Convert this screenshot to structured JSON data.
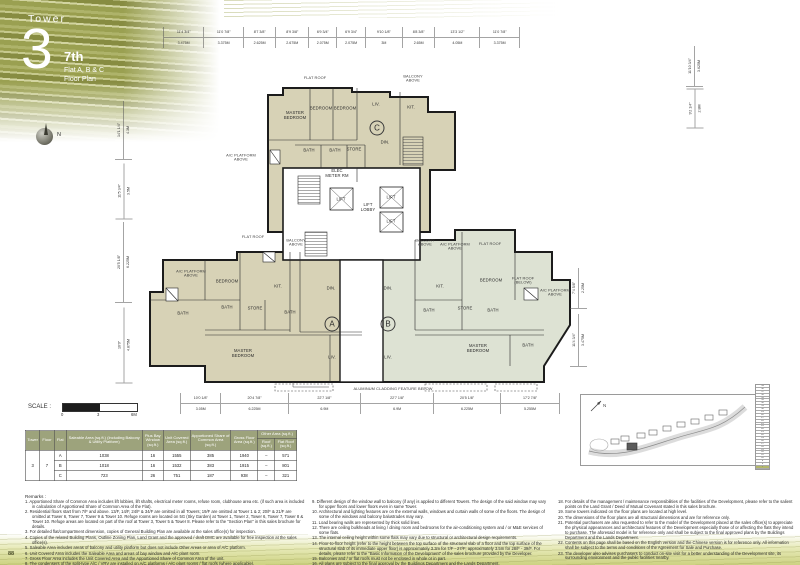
{
  "header": {
    "eyebrow": "Tower",
    "number": "3",
    "floor": "7th",
    "unit_line": "Flat A, B & C",
    "plan_line": "Floor Plan"
  },
  "compass": {
    "label": "N"
  },
  "key_plan": {
    "north_label": "N"
  },
  "page_number": "88",
  "scale_bar": {
    "label": "SCALE :",
    "ticks": [
      "0",
      "3",
      "6M"
    ]
  },
  "dims": {
    "top_pre": {
      "imp": "11'4 3/4\"",
      "met": "3.475M",
      "m": 3.475
    },
    "top": [
      {
        "imp": "11'0 7/8\"",
        "met": "3.375M",
        "m": 3.375
      },
      {
        "imp": "8'7 3/8\"",
        "met": "2.625M",
        "m": 2.625
      },
      {
        "imp": "8'9 3/8\"",
        "met": "2.675M",
        "m": 2.675
      },
      {
        "imp": "6'9 3/4\"",
        "met": "2.075M",
        "m": 2.075
      },
      {
        "imp": "6'9 3/4\"",
        "met": "2.075M",
        "m": 2.075
      },
      {
        "imp": "9'10 1/8\"",
        "met": "3M",
        "m": 3
      },
      {
        "imp": "8'8 3/8\"",
        "met": "2.65M",
        "m": 2.65
      },
      {
        "imp": "13'3 1/2\"",
        "met": "4.05M",
        "m": 4.05
      },
      {
        "imp": "11'0 7/8\"",
        "met": "3.375M",
        "m": 3.375
      }
    ],
    "bottom": [
      {
        "imp": "10'0 1/8\"",
        "met": "3.05M",
        "m": 3.05
      },
      {
        "imp": "20'4 7/8\"",
        "met": "6.225M",
        "m": 6.225
      },
      {
        "imp": "22'7 1/8\"",
        "met": "6.9M",
        "m": 6.9
      },
      {
        "imp": "22'7 1/8\"",
        "met": "6.9M",
        "m": 6.9
      },
      {
        "imp": "20'5 1/8\"",
        "met": "6.225M",
        "m": 6.225
      },
      {
        "imp": "17'2 7/8\"",
        "met": "5.255M",
        "m": 5.255
      }
    ],
    "left": [
      {
        "imp": "14'1 1/4\"",
        "met": "4.3M",
        "cx": 123,
        "cy": 130,
        "len": 58
      },
      {
        "imp": "11'5 3/4\"",
        "met": "3.5M",
        "cx": 123,
        "cy": 191,
        "len": 55
      },
      {
        "imp": "20'5 1/8\"",
        "met": "6.225M",
        "cx": 123,
        "cy": 262,
        "len": 80
      },
      {
        "imp": "16'0\"",
        "met": "4.875M",
        "cx": 123,
        "cy": 345,
        "len": 75
      }
    ],
    "right": [
      {
        "imp": "7'4 5/8\"",
        "met": "2.25M",
        "cx": 578,
        "cy": 288,
        "len": 40
      },
      {
        "imp": "11'4 3/4\"",
        "met": "3.475M",
        "cx": 578,
        "cy": 340,
        "len": 52
      }
    ],
    "top_right": [
      {
        "imp": "11'10 3/4\"",
        "met": "3.625M",
        "cx": 694,
        "cy": 66,
        "len": 40
      },
      {
        "imp": "9'2 1/4\"",
        "met": "2.8M",
        "cx": 694,
        "cy": 108,
        "len": 38
      }
    ]
  },
  "plan": {
    "cladding": "ALUMINUM CLADDING FEATURE BELOW",
    "circles": [
      {
        "t": "C",
        "x": 252,
        "y": 80
      },
      {
        "t": "A",
        "x": 207,
        "y": 276
      },
      {
        "t": "B",
        "x": 263,
        "y": 276
      }
    ],
    "labels": [
      {
        "t": "FLAT ROOF",
        "x": 190,
        "y": 30,
        "s": "note"
      },
      {
        "t": "BALCONY\nABOVE",
        "x": 288,
        "y": 31,
        "s": "note"
      },
      {
        "t": "A/C PLATFORM\nABOVE",
        "x": 116,
        "y": 110,
        "s": "note"
      },
      {
        "t": "MASTER\nBEDROOM",
        "x": 170,
        "y": 68
      },
      {
        "t": "BEDROOM",
        "x": 196,
        "y": 61
      },
      {
        "t": "BEDROOM",
        "x": 220,
        "y": 61
      },
      {
        "t": "LIV.",
        "x": 251,
        "y": 57
      },
      {
        "t": "KIT.",
        "x": 286,
        "y": 60
      },
      {
        "t": "DIN.",
        "x": 260,
        "y": 95
      },
      {
        "t": "BATH",
        "x": 184,
        "y": 103
      },
      {
        "t": "BATH",
        "x": 210,
        "y": 103
      },
      {
        "t": "STORE",
        "x": 229,
        "y": 102
      },
      {
        "t": "ELEC\nMETER RM",
        "x": 212,
        "y": 126
      },
      {
        "t": "LIFT",
        "x": 216,
        "y": 152
      },
      {
        "t": "LIFT\nLOBBY",
        "x": 243,
        "y": 160
      },
      {
        "t": "LIFT",
        "x": 266,
        "y": 150
      },
      {
        "t": "LIFT",
        "x": 266,
        "y": 174
      },
      {
        "t": "FLAT ROOF",
        "x": 128,
        "y": 189,
        "s": "note"
      },
      {
        "t": "BALCONY\nABOVE",
        "x": 171,
        "y": 195,
        "s": "note"
      },
      {
        "t": "A/C PLATFORM\nABOVE",
        "x": 66,
        "y": 226,
        "s": "note"
      },
      {
        "t": "BEDROOM",
        "x": 102,
        "y": 234
      },
      {
        "t": "KIT.",
        "x": 153,
        "y": 239
      },
      {
        "t": "DIN.",
        "x": 206,
        "y": 241
      },
      {
        "t": "BATH",
        "x": 58,
        "y": 266
      },
      {
        "t": "BATH",
        "x": 102,
        "y": 260
      },
      {
        "t": "STORE",
        "x": 130,
        "y": 261
      },
      {
        "t": "BATH",
        "x": 165,
        "y": 265
      },
      {
        "t": "MASTER\nBEDROOM",
        "x": 118,
        "y": 306
      },
      {
        "t": "LIV.",
        "x": 207,
        "y": 310
      },
      {
        "t": "BALCONY\nABOVE",
        "x": 300,
        "y": 195,
        "s": "note"
      },
      {
        "t": "A/C PLATFORM\nABOVE",
        "x": 330,
        "y": 199,
        "s": "note"
      },
      {
        "t": "FLAT ROOF",
        "x": 365,
        "y": 196,
        "s": "note"
      },
      {
        "t": "DIN.",
        "x": 263,
        "y": 241
      },
      {
        "t": "KIT.",
        "x": 315,
        "y": 239
      },
      {
        "t": "BEDROOM",
        "x": 366,
        "y": 233
      },
      {
        "t": "FLAT ROOF\n(BELOW)",
        "x": 398,
        "y": 233,
        "s": "note"
      },
      {
        "t": "A/C PLATFORM\nABOVE",
        "x": 430,
        "y": 245,
        "s": "note"
      },
      {
        "t": "BATH",
        "x": 304,
        "y": 263
      },
      {
        "t": "STORE",
        "x": 340,
        "y": 261
      },
      {
        "t": "BATH",
        "x": 368,
        "y": 263
      },
      {
        "t": "MASTER\nBEDROOM",
        "x": 353,
        "y": 301
      },
      {
        "t": "BATH",
        "x": 403,
        "y": 298
      },
      {
        "t": "LIV.",
        "x": 263,
        "y": 310
      }
    ]
  },
  "table": {
    "h": {
      "tower": "Tower",
      "floor": "Floor",
      "flat": "Flat",
      "saleable": "Saleable Area (sq.ft.) (Including Balcony & Utility Platform)",
      "bay": "Plus Bay Window (sq.ft.)",
      "unit": "Unit Covered Area (sq.ft.)",
      "common": "Apportioned Share of Common Area (sq.ft.)",
      "gross": "Gross Floor Area (sq.ft.)",
      "other": "Other Area (sq.ft.)",
      "roof": "Roof (sq.ft.)",
      "flat_roof": "Flat Roof (sq.ft.)"
    },
    "tower": "3",
    "floor": "7",
    "rows": [
      {
        "flat": "A",
        "saleable": "1038",
        "bay": "16",
        "unit": "1555",
        "common": "385",
        "gross": "1940",
        "roof": "–",
        "flat_roof": "571"
      },
      {
        "flat": "B",
        "saleable": "1018",
        "bay": "16",
        "unit": "1532",
        "common": "383",
        "gross": "1915",
        "roof": "–",
        "flat_roof": "801"
      },
      {
        "flat": "C",
        "saleable": "723",
        "bay": "26",
        "unit": "751",
        "common": "187",
        "gross": "938",
        "roof": "–",
        "flat_roof": "321"
      }
    ]
  },
  "remarks": {
    "title": "Remarks :",
    "col1": [
      "1. Apportioned Share of Common Area includes lift lobbies, lift shafts, electrical meter rooms, refuse room, clubhouse area etc. (if such area is included in calculation of Apportioned Share of Common Area of the Flat).",
      "2. Residential floors start from 7/F and above. 13/F, 14/F, 24/F & 34/F are omitted in all Towers; 19/F are omitted at Tower 1 & 2; 20/F & 21/F are omitted at Tower 6, Tower 7, Tower 9 & Tower 10. Refuge rooms are located on 5G (Sky Garden) at Tower 1, Tower 2, Tower 6, Tower 7, Tower 8 & Tower 10. Refuge areas are located on part of the roof at Tower 3, Tower 5 & Tower 8. Please refer to the \"Section Plan\" in this sales brochure for details.",
      "3. For detailed flat/compartment dimension, copies of General Building Plan are available at the sales office(s) for inspection.",
      "4. Copies of the related Building Plans, Outline Zoning Plan, Land Grant and the approved / draft DMC are available for free inspection at the sales office(s).",
      "5. Saleable Area includes areas of balcony and utility platform but does not include Other Areas or area of A/C platform.",
      "6. Unit Covered Area includes the Saleable Area and areas of bay window and A/C plant room.",
      "7. Gross Floor Area includes the Unit Covered Area and the Apportioned Share of Common Area of the unit.",
      "8. The condensers of the split-type A/C / VRV are installed on A/C platforms / A/C plant rooms / flat roofs (where applicable)."
    ],
    "col2": [
      "9. Different design of the window wall to balcony (if any) is applied to different Towers. The design of the said window may vary for upper floors and lower floors even in same Tower.",
      "10. Architectural and lighting features are on the external walls, windows and curtain walls of some of the floors. The design of some of the windows and balcony balustrades may vary.",
      "11. Load bearing walls are represented by thick solid lines.",
      "12. There are ceiling bulkheads at living / dining room and bedrooms for the air-conditioning system and / or M&E services of some flats.",
      "13. The internal ceiling height within some flats may vary due to structural or architectural design requirements.",
      "14. Floor-to-floor height (refer to the height between the top surface of the structural slab of a floor and the top surface of the structural slab of its immediate upper floor) is approximately 3.3m for 7/F - 27/F; approximately 3.5m for 28/F - 39/F. For details, please refer to the \"Basic Information of the Development\" of the sales brochure provided by the Developer.",
      "15. Balconies and / or flat roofs must not be enclosed in whole or in part.",
      "16. All plans are subject to the final approval by the Buildings Department and the Lands Department.",
      "17. The internal areas of flats on upper floors are in general slightly larger than the internal areas of flats on the lower floors due to the reducing thickness of structural walls on those floors."
    ],
    "col3": [
      "18. For details of the management / maintenance responsibilities of the facilities of the Development, please refer to the salient points on the Land Grant / Deed of Mutual Covenant stated in this sales brochure.",
      "19. Some towers indicated on the floor plans are located at high level.",
      "20. The dimensions of the floor plans are all structural dimensions and are for reference only.",
      "21. Potential purchasers are also requested to refer to the model of the Development placed at the sales office(s) to appreciate the physical appearances and architectural features of the Development especially those of or affecting the flats they intend to purchase. The aforesaid model is for reference only and shall be subject to the final approved plans by the Buildings Department and the Lands Department.",
      "22. Contents on this page shall be based on the English version and the Chinese version is for reference only. All information shall be subject to the terms and conditions of the Agreement for Sale and Purchase.",
      "23. The developer also advises purchasers to conduct on-site visit for a better understanding of the Development site, its surrounding environment and the public facilities nearby."
    ]
  },
  "floor_strip": {
    "floors": [
      "39",
      "38",
      "37",
      "36",
      "35",
      "33",
      "32",
      "31",
      "30",
      "29",
      "28",
      "27",
      "26",
      "25",
      "23",
      "22",
      "21",
      "20",
      "19",
      "18",
      "17",
      "16",
      "15",
      "12",
      "11",
      "10",
      "9",
      "8",
      "7"
    ],
    "highlight": "7"
  }
}
